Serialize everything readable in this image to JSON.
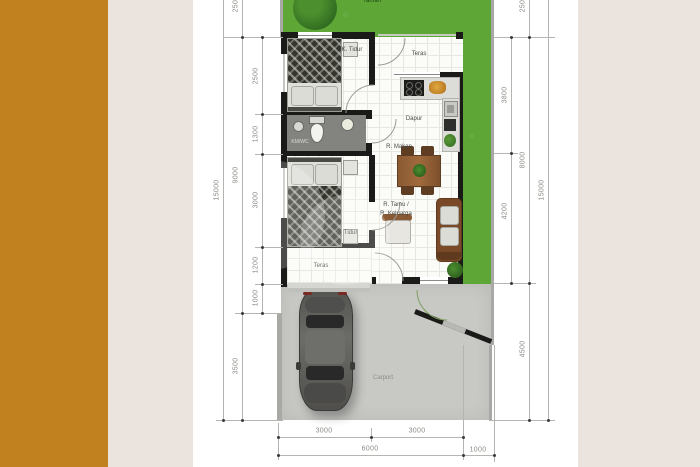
{
  "palette": {
    "accent_bar": "#c2811f",
    "page_background": "#ebe3dd",
    "panel": "#ffffff",
    "grass": "#5ea636",
    "tree": "#2f6a20",
    "wall": "#1a1a18",
    "carport_concrete": "#c8c8c5",
    "dimension_text": "#8b8b87",
    "wood": "#8a5a33"
  },
  "labels": {
    "garden": "Taman",
    "bedroom1": "K. Tidur",
    "terrace_top": "Teras",
    "kitchen": "Dapur",
    "dining": "R. Makan",
    "bathroom": "KM/WC",
    "bedroom2": "K. Tidur",
    "living1": "R. Tamu /",
    "living2": "R. Keluarga",
    "terrace_bottom": "Teras",
    "carport": "Carport"
  },
  "dimensions": {
    "left_inner": [
      "2500",
      "1300",
      "3000",
      "1200",
      "1000"
    ],
    "left_mid": [
      "2500",
      "9000",
      "3500"
    ],
    "left_outer": [
      "15000"
    ],
    "right_inner": [
      "3800",
      "4200"
    ],
    "right_mid": [
      "2500",
      "8000",
      "4500"
    ],
    "right_outer": [
      "15000"
    ],
    "bottom_inner": [
      "3000",
      "3000"
    ],
    "bottom_outer": [
      "6000",
      "1000"
    ]
  }
}
